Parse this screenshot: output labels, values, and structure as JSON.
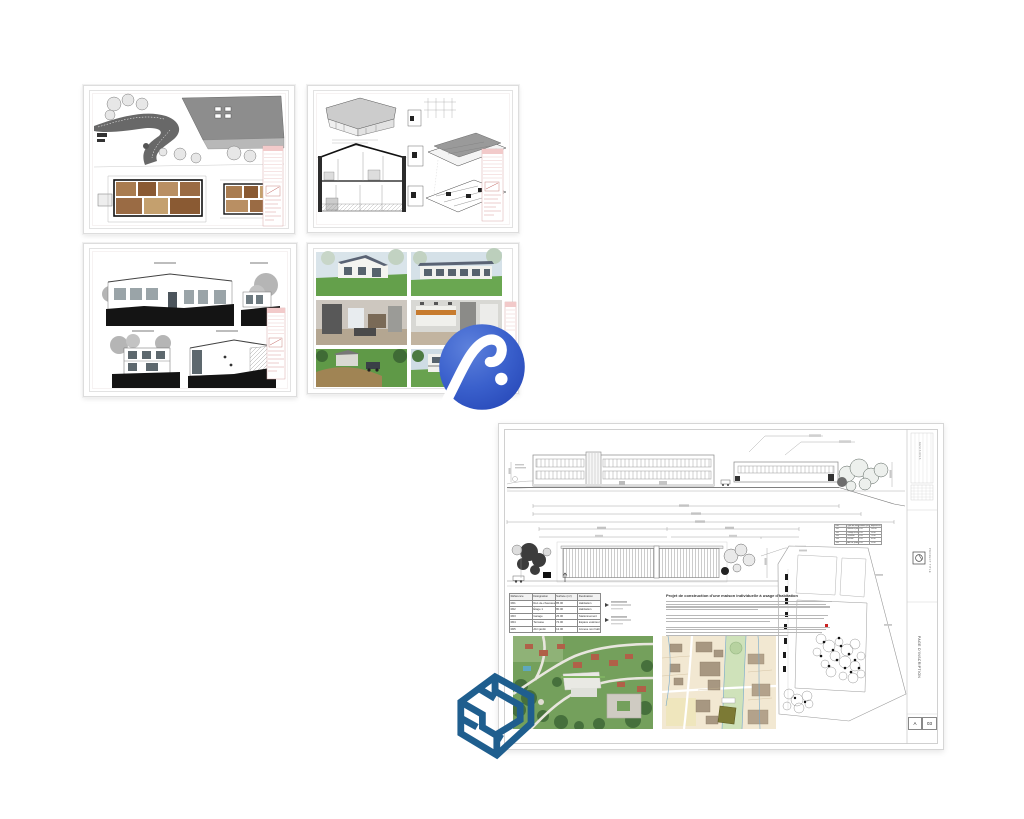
{
  "page": {
    "background": "#ffffff"
  },
  "logos": {
    "archicad": {
      "name": "ArchiCAD logo",
      "color_dark": "#2748b8",
      "color_mid": "#3a60cc",
      "color_light": "#5d81dc",
      "mark": "#ffffff"
    },
    "sketchup": {
      "name": "SketchUp logo",
      "color": "#1f5e8e"
    }
  },
  "thumbnails": [
    {
      "id": "site-plan",
      "name": "Site plan and floor plans sheet"
    },
    {
      "id": "section-axonometry",
      "name": "Section and axonometric views sheet"
    },
    {
      "id": "elevations",
      "name": "Elevations sheet"
    },
    {
      "id": "renderings",
      "name": "Exterior and interior renderings sheet"
    }
  ],
  "big_sheet": {
    "description_title": "Projet de construction d'une maison individuelle à usage d'habitation",
    "room_table": {
      "headers": [
        "Référence",
        "Désignation",
        "Surface (m²)",
        "Destination"
      ],
      "rows": [
        [
          "R01",
          "Rez-de-chaussée",
          "85.00",
          "Habitation"
        ],
        [
          "R02",
          "Étage 1",
          "80.00",
          "Habitation"
        ],
        [
          "R03",
          "Garage",
          "25.00",
          "Stationnement"
        ],
        [
          "R04",
          "Terrasse",
          "72.00",
          "Espace extérieur"
        ],
        [
          "R05",
          "Abri jardin",
          "12.00",
          "Annexe non habitable"
        ]
      ]
    },
    "volume_table": {
      "headers": [
        "Réf.",
        "Type de volume",
        "Surface (m²)",
        "Emprise au sol (m²)"
      ],
      "rows": [
        [
          "V01",
          "Bâtiment principal",
          "1.00",
          "135.00"
        ],
        [
          "V02",
          "Garage accolé",
          "1.00",
          "25.00"
        ],
        [
          "V03",
          "Terrasse",
          "1.00",
          "72.00"
        ],
        [
          "V04",
          "Piscine",
          "1.00",
          "32.00"
        ],
        [
          "V05",
          "Abri de jardin",
          "1.00",
          "12.00"
        ]
      ]
    },
    "title_strip": {
      "revisions_label": "REVISIONS",
      "project_label": "PROJECT TITLE",
      "sheet_label": "PAGE D'INSCRIPTION",
      "index_letter": "A",
      "sheet_number": "03"
    }
  }
}
